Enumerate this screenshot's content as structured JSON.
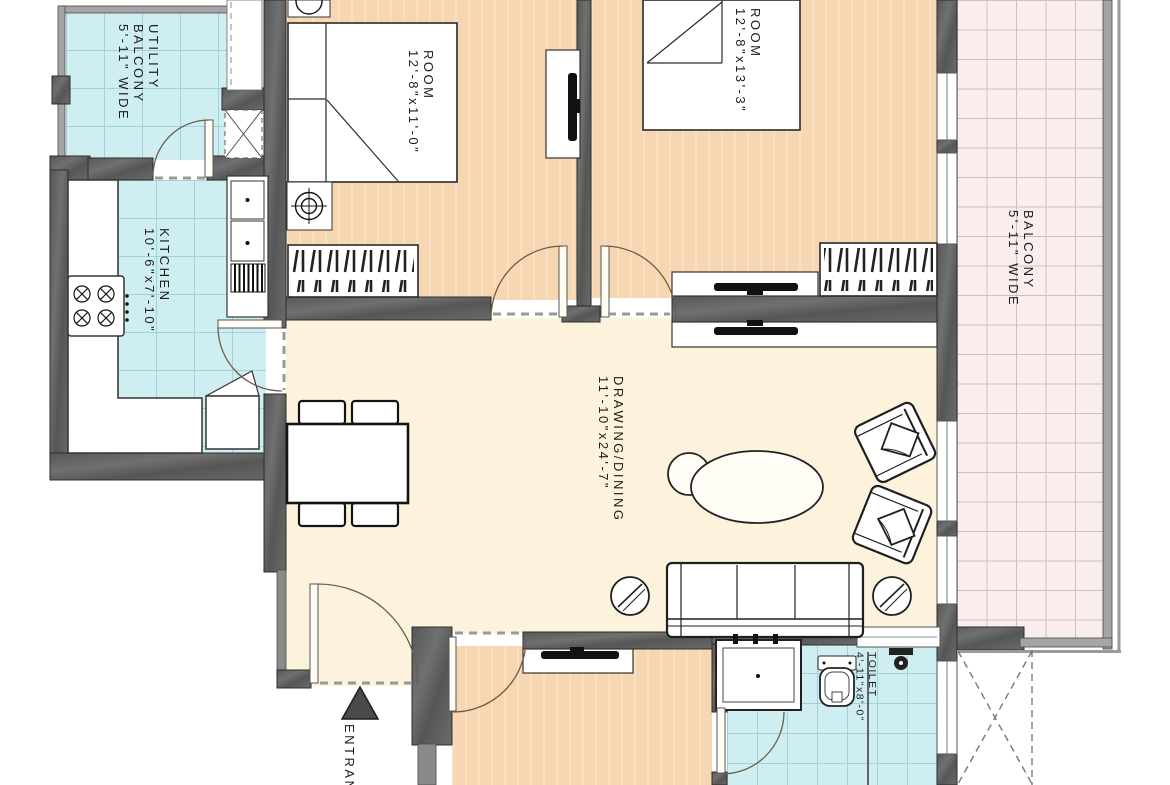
{
  "plan": {
    "rooms": {
      "utility_balcony": {
        "line1": "UTILITY",
        "line2": "BALCONY",
        "dimension": "5'-11\" WIDE"
      },
      "kitchen": {
        "name": "KITCHEN",
        "dimension": "10'-6\"x7'-10\""
      },
      "room_1": {
        "name": "ROOM",
        "dimension": "12'-8\"x11'-0\""
      },
      "room_2": {
        "name": "ROOM",
        "dimension": "12'-8\"x13'-3\""
      },
      "drawing_dining": {
        "name": "DRAWING/DINING",
        "dimension": "11'-10\"x24'-7\""
      },
      "balcony": {
        "name": "BALCONY",
        "dimension": "5'-11\" WIDE"
      },
      "toilet": {
        "name": "TOILET",
        "dimension": "4'-11\"x8'-0\""
      },
      "entrance": {
        "name": "ENTRANCE",
        "arrow_icon": "entrance-arrow-up"
      }
    },
    "colors": {
      "wall_dark": "#5e5e5e",
      "wall_light": "#a5a5a5",
      "tile_cyan": "#cfeef1",
      "tile_cyan_line": "#9fd3d9",
      "floor_room": "#f7d7b1",
      "floor_living": "#fdf3dc",
      "balcony_tile": "#f9eded",
      "balcony_tile_line": "#cfbdbf",
      "label_text": "#1c1c1c",
      "entrance_arrow": "#4a4a4a"
    }
  }
}
